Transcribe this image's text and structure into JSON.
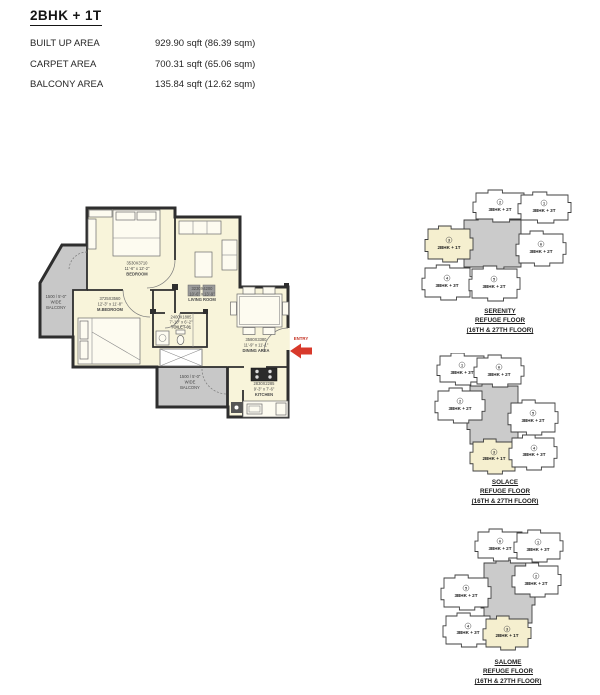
{
  "header": {
    "title": "2BHK + 1T",
    "areas": [
      {
        "label": "BUILT UP  AREA",
        "value": "929.90 sqft (86.39 sqm)"
      },
      {
        "label": "CARPET AREA",
        "value": "700.31 sqft (65.06 sqm)"
      },
      {
        "label": "BALCONY  AREA",
        "value": "135.84 sqft (12.62 sqm)"
      }
    ]
  },
  "floor_plan": {
    "rooms": {
      "bedroom": {
        "dim_mm": "3530X3710",
        "dim_ft": "11'-6\" x 12'-2\"",
        "name": "BEDROOM"
      },
      "living": {
        "dim_mm": "3230X4200",
        "dim_ft": "10'-6\" x 13'-9\"",
        "name": "LIVING ROOM"
      },
      "mbedroom": {
        "dim_mm": "3725X3560",
        "dim_ft": "12'-3\" x 11'-8\"",
        "name": "M.BEDROOM"
      },
      "toilet": {
        "dim_mm": "2400X1885",
        "dim_ft": "7'-10\" x 6'-2\"",
        "name": "TOILET-01"
      },
      "dining": {
        "dim_mm": "3580X3380",
        "dim_ft": "11'-9\" x 11'-1\"",
        "name": "DINING AREA"
      },
      "kitchen": {
        "dim_mm": "2830X2285",
        "dim_ft": "9'-3\" x 7'-6\"",
        "name": "KITCHEN"
      }
    },
    "balcony_left": {
      "l1": "1500 / 5'-0\"",
      "l2": "WIDE",
      "l3": "BALCONY"
    },
    "balcony_bottom": {
      "l1": "1500 / 5'-0\"",
      "l2": "WIDE",
      "l3": "BALCONY"
    },
    "entry": "ENTRY"
  },
  "key_plans": [
    {
      "name": "SERENITY",
      "floor": "REFUGE FLOOR",
      "range": "(16TH & 27TH FLOOR)",
      "units": [
        {
          "num": "2",
          "label": "3BHK + 2T"
        },
        {
          "num": "1",
          "label": "3BHK + 3T"
        },
        {
          "num": "3",
          "label": "2BHK + 1T"
        },
        {
          "num": "6",
          "label": "3BHK + 2T"
        },
        {
          "num": "4",
          "label": "3BHK + 3T"
        },
        {
          "num": "5",
          "label": "3BHK + 2T"
        }
      ]
    },
    {
      "name": "SOLACE",
      "floor": "REFUGE FLOOR",
      "range": "(16TH & 27TH FLOOR)",
      "units": [
        {
          "num": "1",
          "label": "3BHK + 3T"
        },
        {
          "num": "6",
          "label": "3BHK + 2T"
        },
        {
          "num": "2",
          "label": "3BHK + 2T"
        },
        {
          "num": "5",
          "label": "3BHK + 2T"
        },
        {
          "num": "3",
          "label": "2BHK + 1T"
        },
        {
          "num": "4",
          "label": "3BHK + 3T"
        }
      ]
    },
    {
      "name": "SALOME",
      "floor": "REFUGE FLOOR",
      "range": "(16TH & 27TH FLOOR)",
      "units": [
        {
          "num": "6",
          "label": "3BHK + 2T"
        },
        {
          "num": "1",
          "label": "3BHK + 3T"
        },
        {
          "num": "5",
          "label": "3BHK + 2T"
        },
        {
          "num": "2",
          "label": "3BHK + 2T"
        },
        {
          "num": "4",
          "label": "3BHK + 3T"
        },
        {
          "num": "3",
          "label": "2BHK + 1T"
        }
      ]
    }
  ],
  "colors": {
    "room_fill": "#f8f4da",
    "balcony_fill": "#c8c8c8",
    "highlight_fill": "#f5efcf",
    "core_fill": "#cbcbcb",
    "wall": "#2e2e2e",
    "entry_red": "#d8392b"
  }
}
